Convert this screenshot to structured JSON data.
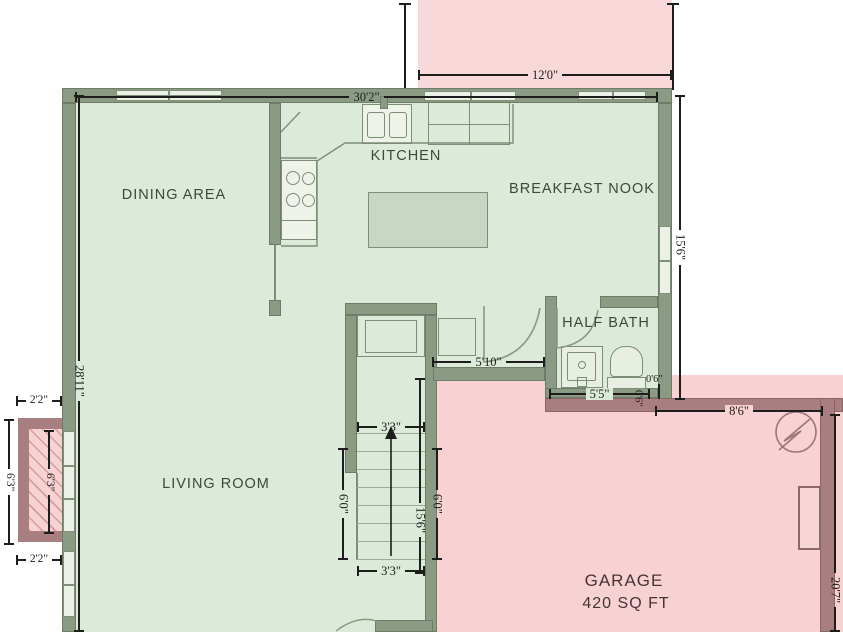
{
  "colors": {
    "floor_green": "#dcead9",
    "wall_green": "#8b9a83",
    "deck_pink": "#f8d8d8",
    "garage_pink": "#f8d2d2",
    "garage_wall_mauve": "#a87e80",
    "island_fill": "#c9d6c4",
    "dimension_text": "#1d1d1d",
    "room_label_text": "#3a493a"
  },
  "rooms": {
    "dining": "DINING AREA",
    "kitchen": "KITCHEN",
    "breakfast_nook": "BREAKFAST NOOK",
    "half_bath": "HALF BATH",
    "living_room": "LIVING ROOM",
    "garage": "GARAGE",
    "garage_sqft": "420 SQ FT"
  },
  "dims": {
    "deck_width": "12'0\"",
    "main_width": "30'2\"",
    "nook_height": "15'6\"",
    "left_height": "28'11\"",
    "porch_top": "2'2\"",
    "porch_bottom": "2'2\"",
    "porch_outer": "6'3\"",
    "porch_inner": "6'3\"",
    "hall": "5'10\"",
    "bath": "5'5\"",
    "bath_offset": "0'6\"",
    "bath_offset_v": "0'6\"",
    "stairs_top": "3'3\"",
    "stairs_bottom": "3'3\"",
    "stairs_left": "6'0\"",
    "stairs_right": "6'0\"",
    "stair_wall": "15'6\"",
    "garage_width": "8'6\"",
    "garage_height": "20'7\""
  }
}
